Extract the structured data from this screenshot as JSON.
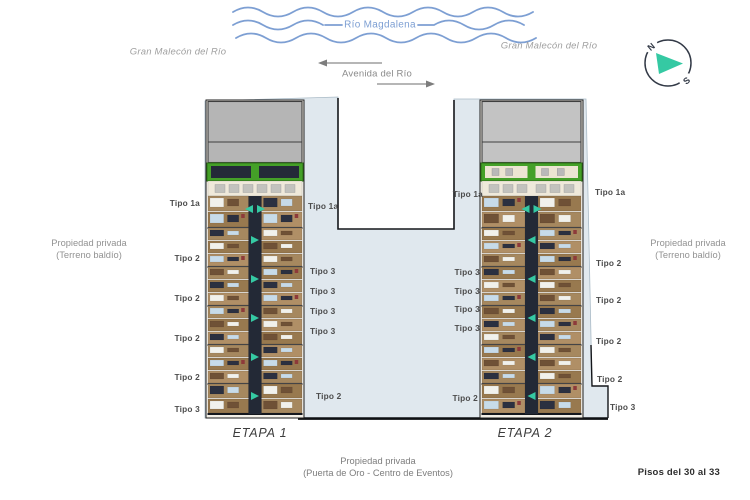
{
  "river": {
    "label": "Río Magdalena"
  },
  "streets": {
    "malecon_left": "Gran Malecón del Río",
    "malecon_right": "Gran Malecón del Río",
    "avenida": "Avenida del Río"
  },
  "compass": {
    "north": "N",
    "south": "S"
  },
  "notes": {
    "private_left": {
      "line1": "Propiedad privada",
      "line2": "(Terreno baldío)"
    },
    "private_right": {
      "line1": "Propiedad privada",
      "line2": "(Terreno baldío)"
    },
    "private_bottom": {
      "line1": "Propiedad privada",
      "line2": "(Puerta de Oro - Centro de Eventos)"
    },
    "floors_note": "Pisos del 30 al 33"
  },
  "towers": [
    {
      "name": "ETAPA 1",
      "unit_labels": [
        {
          "text": "Tipo 1a",
          "x": 200,
          "y": 203,
          "align": "right"
        },
        {
          "text": "Tipo 2",
          "x": 200,
          "y": 258,
          "align": "right"
        },
        {
          "text": "Tipo 2",
          "x": 200,
          "y": 298,
          "align": "right"
        },
        {
          "text": "Tipo 2",
          "x": 200,
          "y": 338,
          "align": "right"
        },
        {
          "text": "Tipo 2",
          "x": 200,
          "y": 377,
          "align": "right"
        },
        {
          "text": "Tipo 3",
          "x": 200,
          "y": 409,
          "align": "right"
        },
        {
          "text": "Tipo 1a",
          "x": 308,
          "y": 206,
          "align": "left"
        },
        {
          "text": "Tipo 3",
          "x": 310,
          "y": 271,
          "align": "left"
        },
        {
          "text": "Tipo 3",
          "x": 310,
          "y": 291,
          "align": "left"
        },
        {
          "text": "Tipo 3",
          "x": 310,
          "y": 311,
          "align": "left"
        },
        {
          "text": "Tipo 3",
          "x": 310,
          "y": 331,
          "align": "left"
        },
        {
          "text": "Tipo 2",
          "x": 316,
          "y": 396,
          "align": "left"
        }
      ]
    },
    {
      "name": "ETAPA 2",
      "unit_labels": [
        {
          "text": "Tipo 1a",
          "x": 483,
          "y": 194,
          "align": "right"
        },
        {
          "text": "Tipo 3",
          "x": 480,
          "y": 272,
          "align": "right"
        },
        {
          "text": "Tipo 3",
          "x": 480,
          "y": 291,
          "align": "right"
        },
        {
          "text": "Tipo 3",
          "x": 480,
          "y": 309,
          "align": "right"
        },
        {
          "text": "Tipo 3",
          "x": 480,
          "y": 328,
          "align": "right"
        },
        {
          "text": "Tipo 2",
          "x": 478,
          "y": 398,
          "align": "right"
        },
        {
          "text": "Tipo 1a",
          "x": 595,
          "y": 192,
          "align": "left"
        },
        {
          "text": "Tipo 2",
          "x": 596,
          "y": 263,
          "align": "left"
        },
        {
          "text": "Tipo 2",
          "x": 596,
          "y": 300,
          "align": "left"
        },
        {
          "text": "Tipo 2",
          "x": 596,
          "y": 341,
          "align": "left"
        },
        {
          "text": "Tipo 2",
          "x": 597,
          "y": 379,
          "align": "left"
        },
        {
          "text": "Tipo 3",
          "x": 610,
          "y": 407,
          "align": "left"
        }
      ]
    }
  ],
  "colors": {
    "water": "#7d9fd3",
    "plaza": "#e0e8ee",
    "green_band": "#44a028",
    "roof_gray": "#b5b5b5",
    "corridor_dark": "#232936",
    "teal": "#35c9a3",
    "unit_tan": "#a6885f",
    "unit_brown": "#98794f"
  }
}
